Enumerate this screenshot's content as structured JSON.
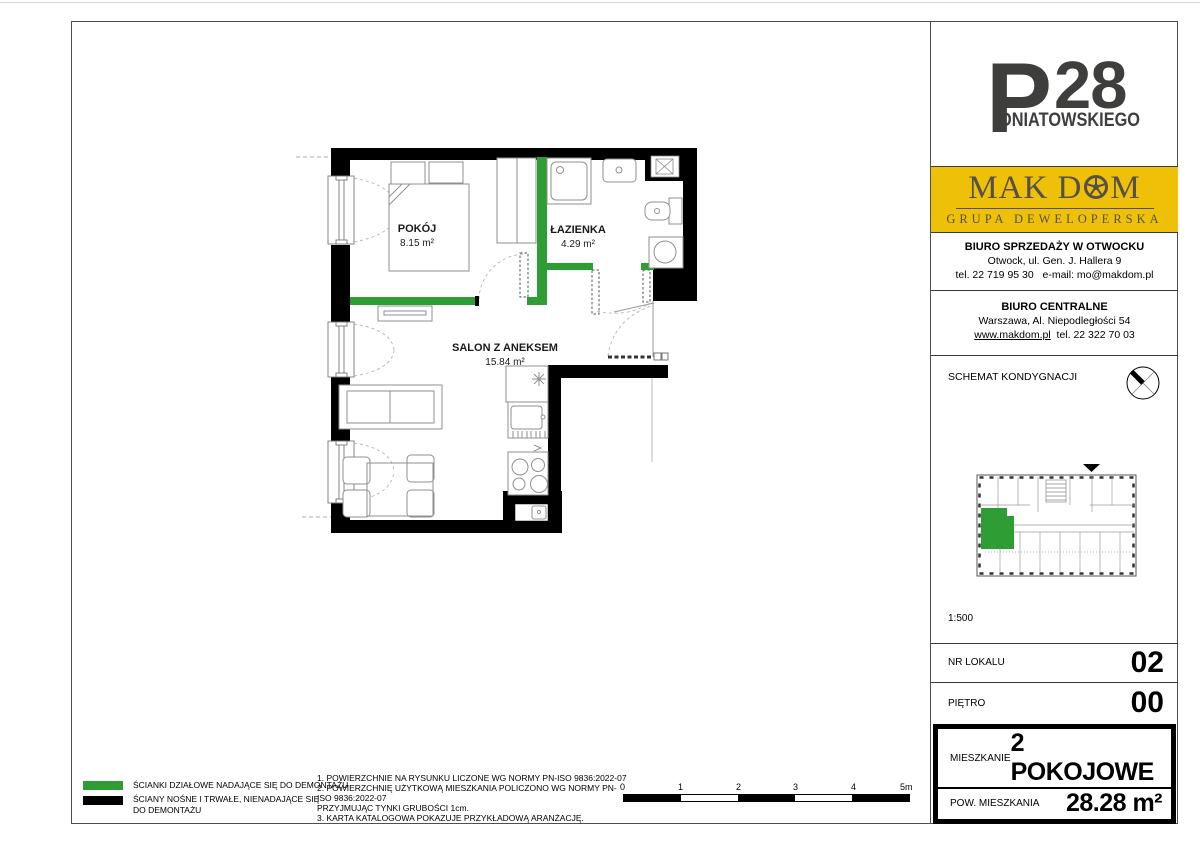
{
  "logo": {
    "letter": "P",
    "number": "28",
    "subtitle": "ONIATOWSKIEGO"
  },
  "developer": {
    "name": "MAK DOM",
    "name_before_wheel": "MAK D",
    "name_after_wheel": "M",
    "tagline": "GRUPA DEWELOPERSKA"
  },
  "office_sales": {
    "title": "BIURO SPRZEDAŻY W OTWOCKU",
    "address": "Otwock, ul. Gen. J. Hallera 9",
    "phone": "tel. 22 719 95 30",
    "email": "e-mail: mo@makdom.pl"
  },
  "office_central": {
    "title": "BIURO CENTRALNE",
    "address": "Warszawa, Al. Niepodległości 54",
    "website": "www.makdom.pl",
    "phone": "tel. 22 322 70 03"
  },
  "schematic": {
    "title": "SCHEMAT KONDYGNACJI",
    "scale": "1:500"
  },
  "details": {
    "unit_label": "NR LOKALU",
    "unit_value": "02",
    "floor_label": "PIĘTRO",
    "floor_value": "00",
    "type_label": "MIESZKANIE",
    "type_value": "2 POKOJOWE",
    "area_label": "POW. MIESZKANIA",
    "area_value": "28.28 m²"
  },
  "plan": {
    "rooms": [
      {
        "name": "POKÓJ",
        "area": "8.15 m²"
      },
      {
        "name": "ŁAZIENKA",
        "area": "4.29 m²"
      },
      {
        "name": "SALON Z ANEKSEM",
        "area": "15.84 m²"
      }
    ]
  },
  "legend": {
    "partition": "ŚCIANKI DZIAŁOWE NADAJĄCE SIĘ DO DEMONTAŻU",
    "structural_line1": "ŚCIANY NOŚNE I TRWAŁE, NIENADAJĄCE SIĘ",
    "structural_line2": "DO DEMONTAŻU"
  },
  "notes": [
    "1. POWIERZCHNIE NA RYSUNKU LICZONE WG NORMY PN-ISO 9836:2022-07",
    "2. POWIERZCHNIĘ UŻYTKOWĄ MIESZKANIA POLICZONO WG NORMY PN-ISO 9836:2022-07",
    "PRZYJMUJĄC TYNKI GRUBOŚCI 1cm.",
    "3. KARTA KATALOGOWA POKAZUJE PRZYKŁADOWĄ ARANŻACJĘ."
  ],
  "scalebar": {
    "labels": [
      "0",
      "1",
      "2",
      "3",
      "4",
      "5m"
    ]
  },
  "colors": {
    "partition_green": "#2E9E34",
    "brand_yellow": "#EFC008",
    "logo_gray": "#3E3E3D",
    "wall_black": "#000000"
  }
}
